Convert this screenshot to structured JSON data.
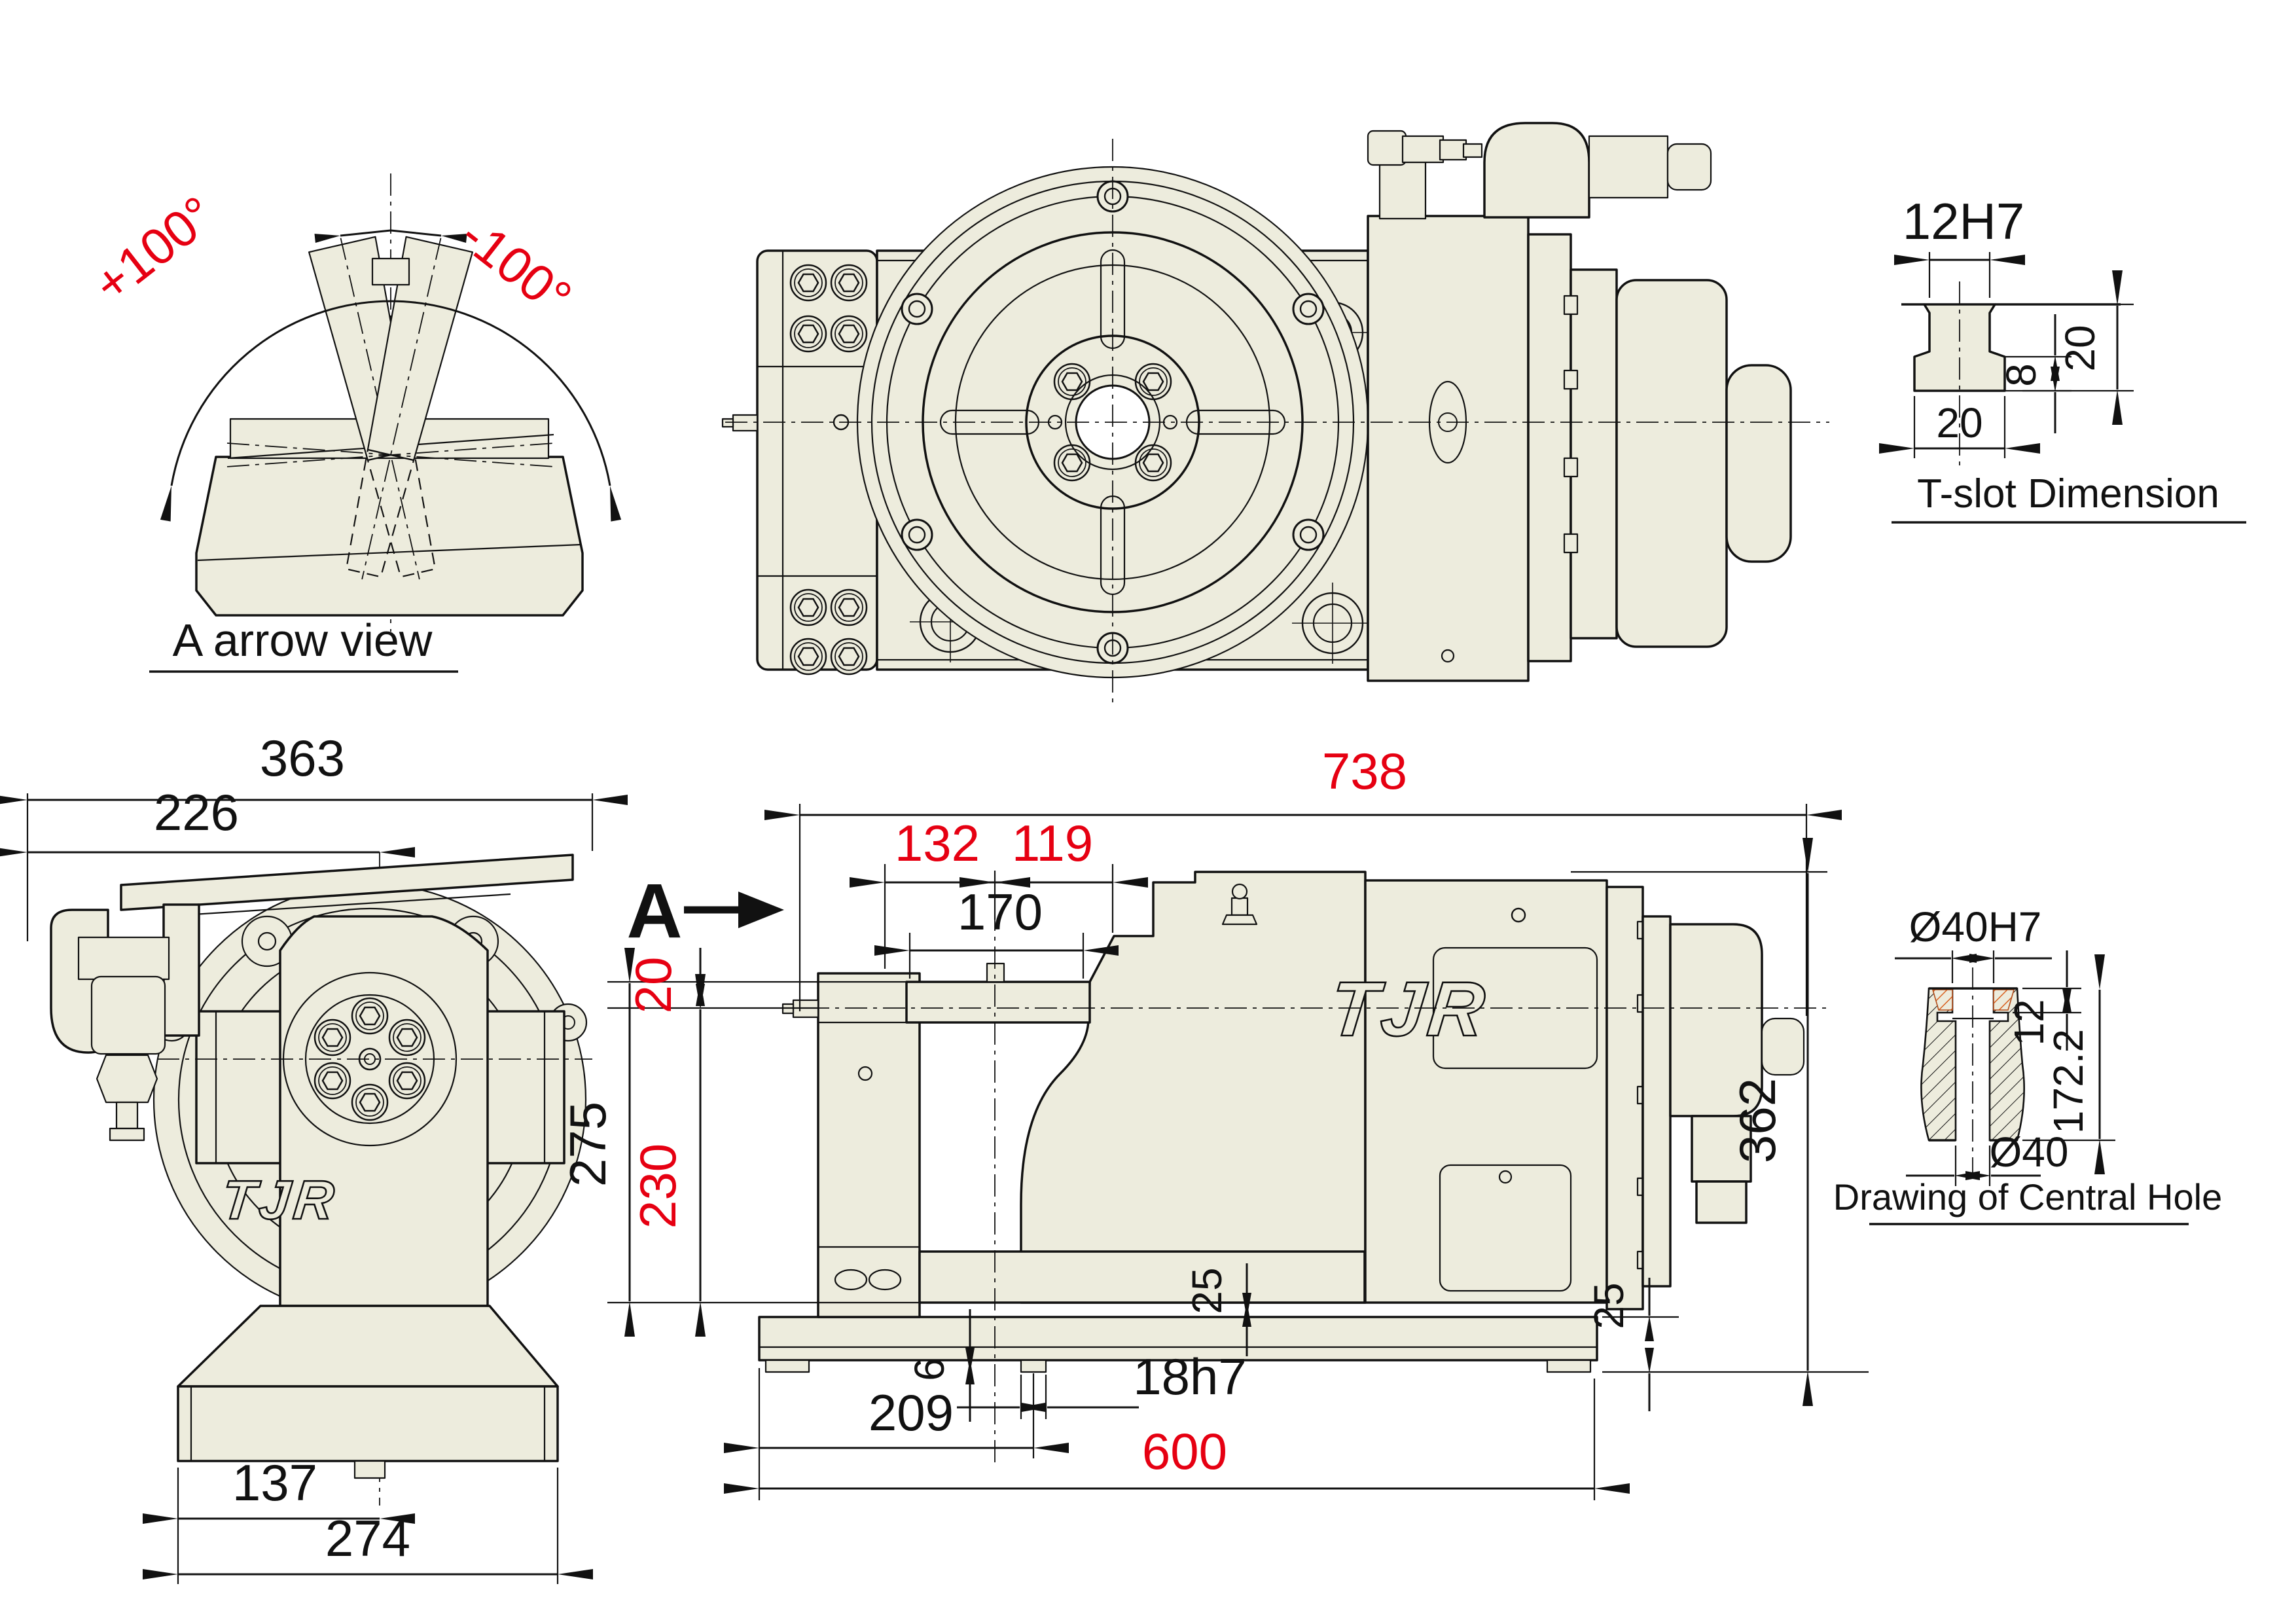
{
  "drawing": {
    "background": "#ffffff",
    "body_fill": "#edecdd",
    "line_color": "#111111",
    "accent_red": "#e60012",
    "views": {
      "arrow_view": {
        "label": "A arrow view",
        "angle_positive": "+100°",
        "angle_negative": "-100°"
      },
      "tslot": {
        "label": "T-slot Dimension",
        "slot_width": "12H7",
        "total_depth": "20",
        "base_height": "8",
        "base_width": "20"
      },
      "front_view": {
        "logo": "TJR",
        "dims": {
          "overall_width": "363",
          "left_to_center": "226",
          "base_left_to_center": "137",
          "base_width": "274"
        }
      },
      "side_view": {
        "view_marker": "A",
        "logo": "TJR",
        "dims": {
          "overall_length": "738",
          "pallet_to_face_left": "132",
          "face_to_housing": "119",
          "pallet_width": "170",
          "axis_offset": "20",
          "height_table": "275",
          "height_axis": "230",
          "overall_height": "362",
          "pad_height_left": "25",
          "pad_height_right": "25",
          "key_offset": "6",
          "key_width": "18h7",
          "key_position": "209",
          "base_length": "600"
        }
      },
      "central_hole": {
        "label": "Drawing of Central Hole",
        "bore_top": "Ø40H7",
        "counterbore_depth": "12",
        "total_depth": "172.2",
        "bore_bottom": "Ø40"
      }
    }
  }
}
